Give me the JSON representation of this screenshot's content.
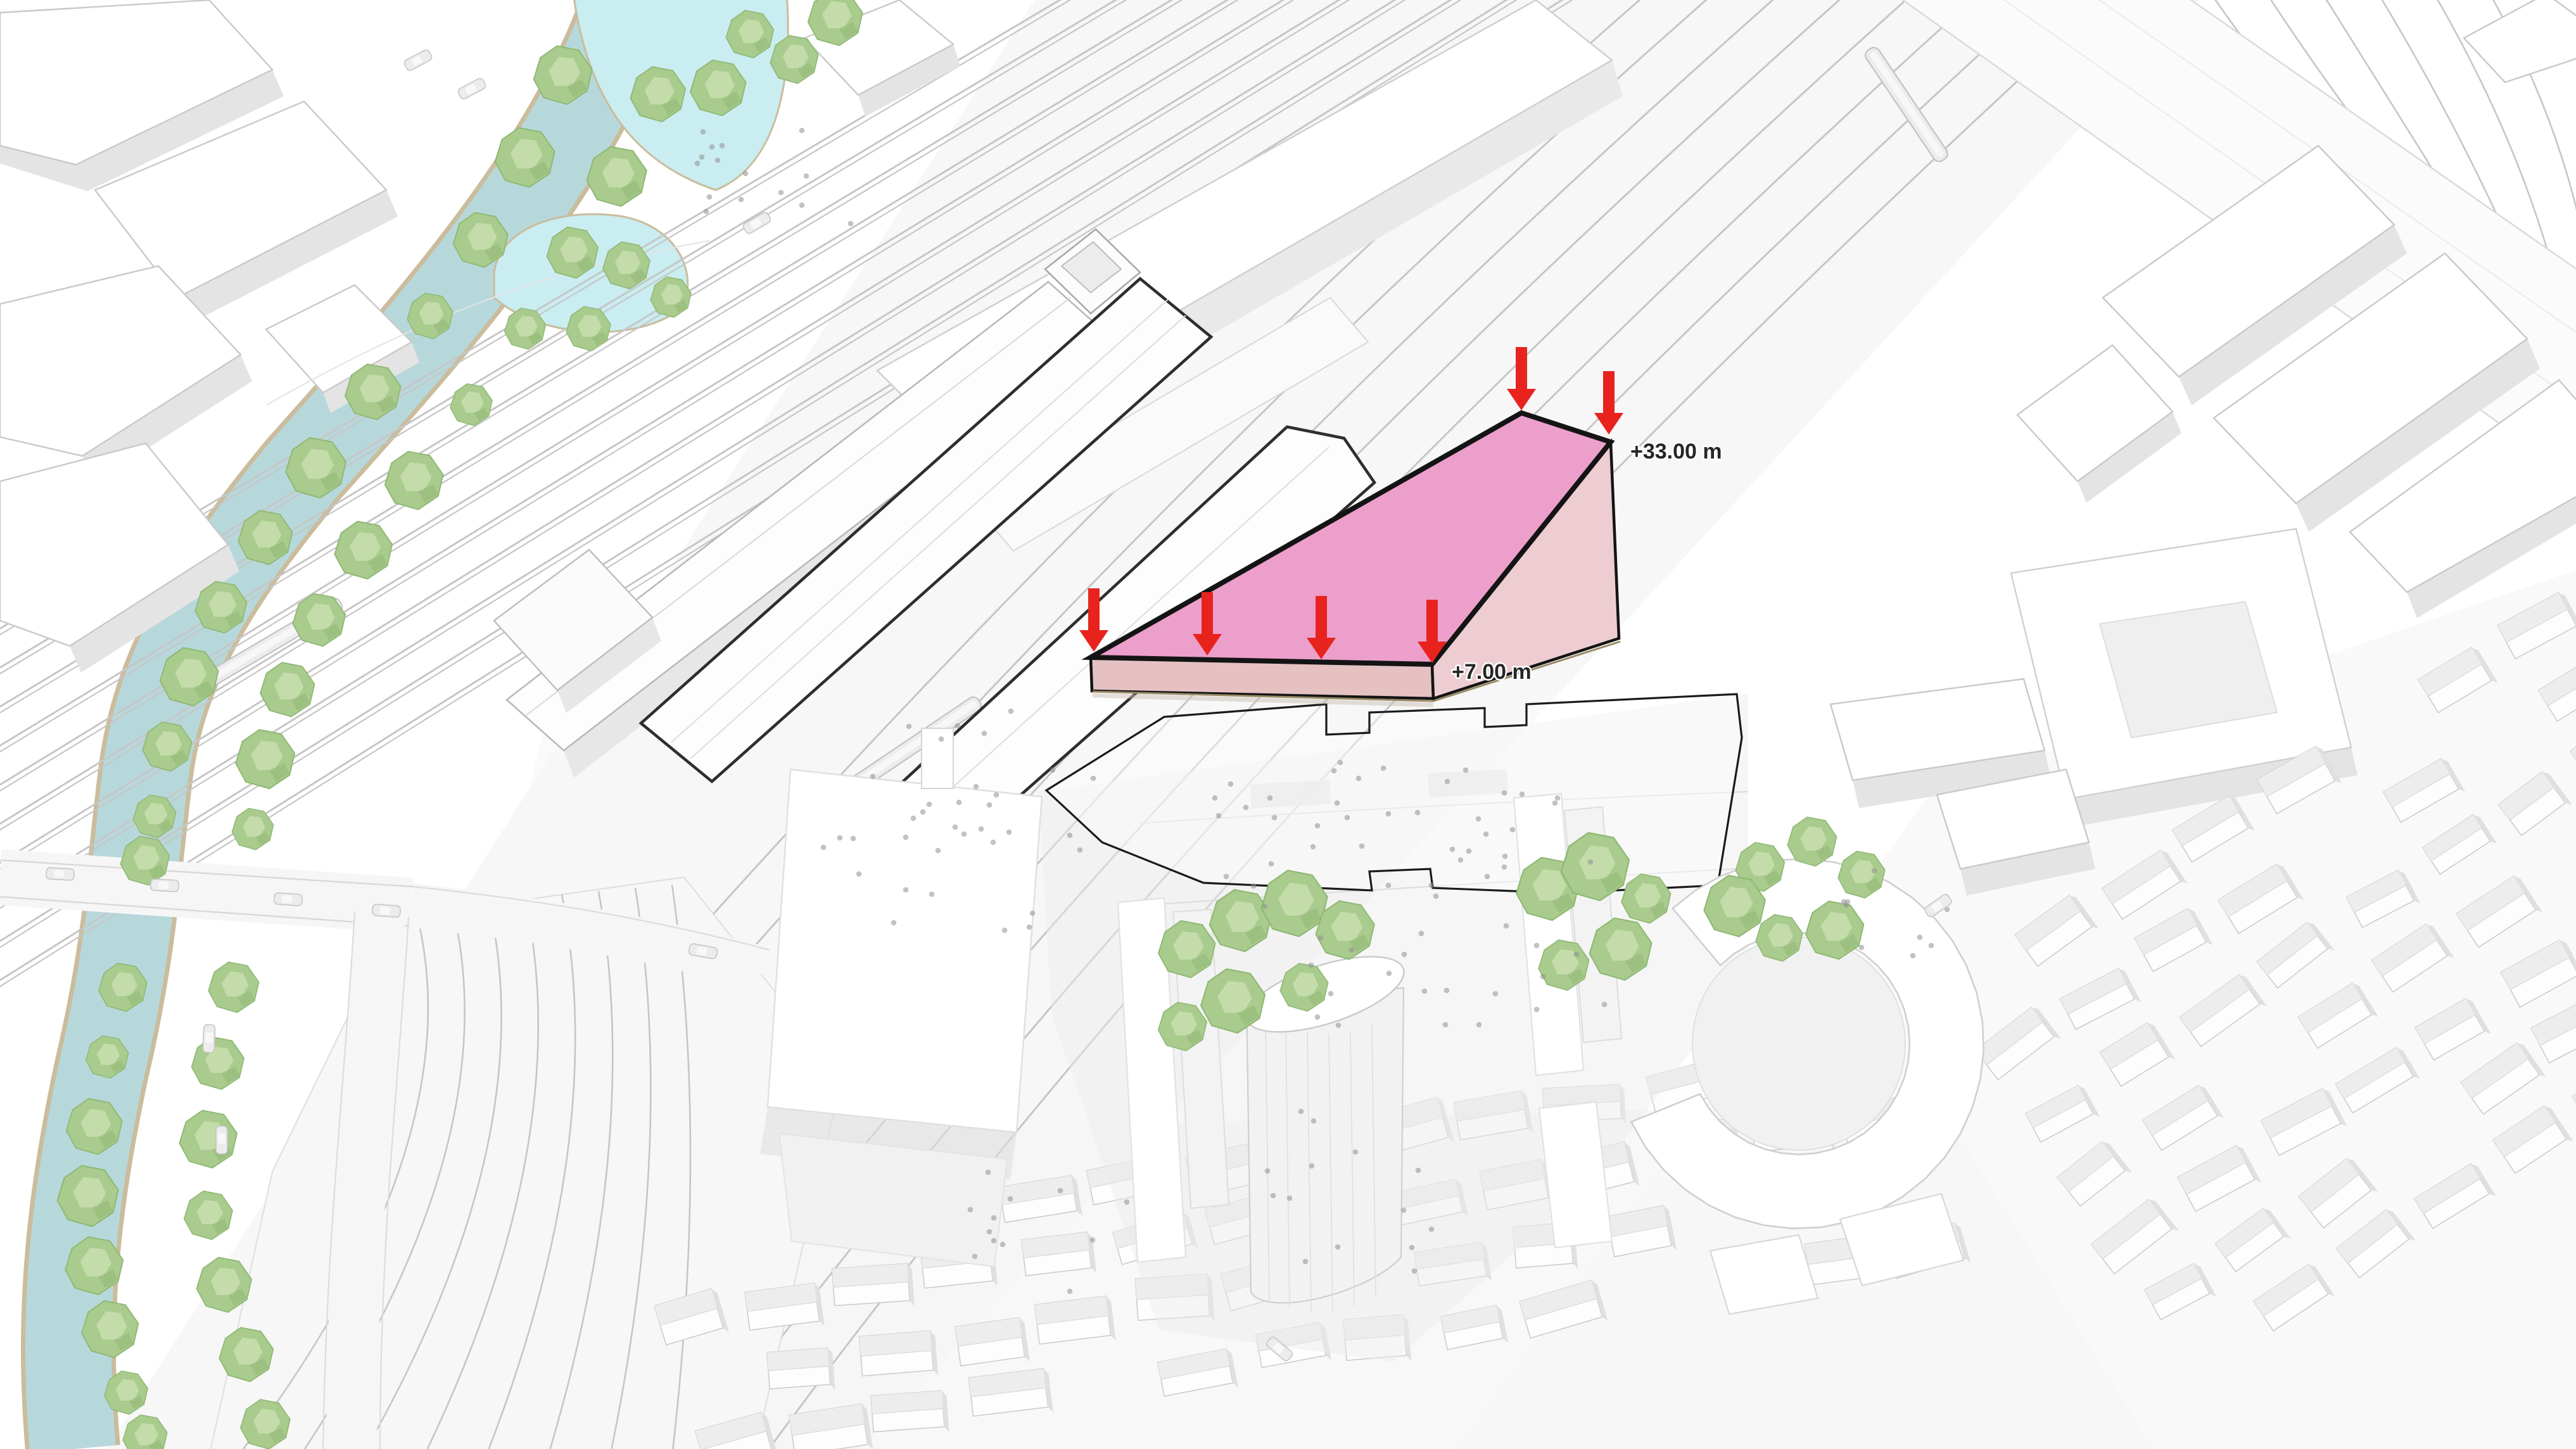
{
  "scene": {
    "type": "3d-urban-massing-diagram",
    "annotations": {
      "upper_height_label": "+33.00 m",
      "lower_height_label": "+7.00 m",
      "arrow_icon": "down-arrow",
      "upper_arrow_count": 2,
      "lower_arrow_count": 4
    },
    "colors": {
      "ink": "#262626",
      "arrow": "#e8231d",
      "massing_top": "#ec9fcb",
      "massing_front": "#e5c1c2",
      "massing_right": "#edcdd2",
      "massing_outline": "#141414",
      "river": "#b7d8db",
      "river_bank": "#cabc9c",
      "pond": "#c9edf0",
      "tree": "#a9cb8d",
      "tree_light": "#c3dcaa",
      "tree_dark": "#8fb874",
      "building": "#ffffff",
      "building_side": "#e4e4e4",
      "building_line": "#c9c9c9",
      "canopy_line": "#2e2e2e",
      "track": "#c6c6c6",
      "wash": "#f1f1f1",
      "site_outline": "#1b1b1b",
      "people": "#8f8f8f",
      "car": "#ececec"
    }
  }
}
